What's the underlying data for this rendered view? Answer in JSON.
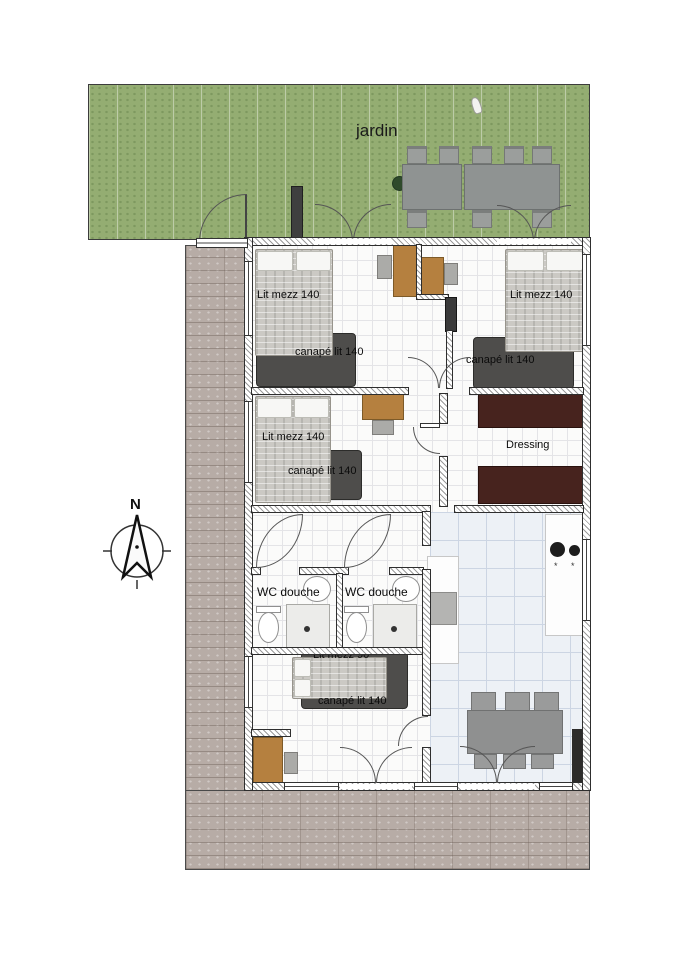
{
  "garden": {
    "label": "jardin"
  },
  "compass": {
    "label": "N"
  },
  "rooms": {
    "bedroom_top_left": {
      "bed_label": "Lit mezz 140",
      "sofa_label": "canapé lit 140"
    },
    "bedroom_top_right": {
      "bed_label": "Lit mezz 140",
      "sofa_label": "canapé lit 140"
    },
    "bedroom_mid_left": {
      "bed_label": "Lit mezz 140",
      "sofa_label": "canapé lit 140"
    },
    "bedroom_bottom": {
      "bed_label": "Lit mezz 90",
      "sofa_label": "canapé lit 140"
    },
    "bathroom_left": {
      "label": "WC douche"
    },
    "bathroom_right": {
      "label": "WC douche"
    },
    "dressing": {
      "label": "Dressing"
    }
  },
  "kitchen": {
    "sink_glyph_left": "*",
    "sink_glyph_right": "*"
  },
  "colors": {
    "garden_green": "#94ad72",
    "paver_gray": "#b7aca6",
    "bed_gray": "#cbc9c4",
    "sofa_dark": "#4e4d4b",
    "desk_brown": "#b5803f",
    "wardrobe_brown": "#47231e",
    "dining_table_gray": "#8f9090",
    "fireplace_dark": "#2c2b2a"
  }
}
